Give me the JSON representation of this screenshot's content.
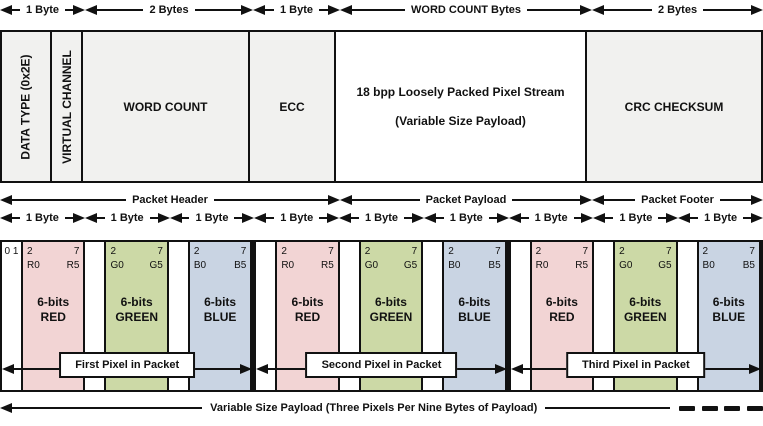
{
  "colors": {
    "field_fill": "#f1f1ef",
    "payload_fill": "#ffffff",
    "red_byte": "#f2d4d4",
    "green_byte": "#ccd9a6",
    "blue_byte": "#c9d4e3",
    "line": "#111111"
  },
  "top_byte_widths": [
    {
      "label": "1 Byte"
    },
    {
      "label": "2 Bytes"
    },
    {
      "label": "1 Byte"
    },
    {
      "label": "WORD COUNT Bytes"
    },
    {
      "label": "2 Bytes"
    }
  ],
  "packet_fields": {
    "data_type": "DATA TYPE (0x2E)",
    "virtual_channel": "VIRTUAL CHANNEL",
    "word_count": "WORD COUNT",
    "ecc": "ECC",
    "payload_line1": "18 bpp Loosely Packed Pixel Stream",
    "payload_line2": "(Variable Size Payload)",
    "crc": "CRC CHECKSUM"
  },
  "sections": {
    "header": "Packet Header",
    "payload": "Packet Payload",
    "footer": "Packet Footer"
  },
  "byte_span_label": "1 Byte",
  "unused_bits": "0 1",
  "rgb_bytes": [
    {
      "bit_lo": "2",
      "bit_hi": "7",
      "sig_lo": "R0",
      "sig_hi": "R5",
      "line1": "6-bits",
      "line2": "RED"
    },
    {
      "bit_lo": "2",
      "bit_hi": "7",
      "sig_lo": "G0",
      "sig_hi": "G5",
      "line1": "6-bits",
      "line2": "GREEN"
    },
    {
      "bit_lo": "2",
      "bit_hi": "7",
      "sig_lo": "B0",
      "sig_hi": "B5",
      "line1": "6-bits",
      "line2": "BLUE"
    }
  ],
  "pixel_captions": [
    "First Pixel in Packet",
    "Second Pixel in Packet",
    "Third Pixel in Packet"
  ],
  "bottom_annotation": "Variable Size Payload (Three Pixels Per Nine Bytes of Payload)"
}
